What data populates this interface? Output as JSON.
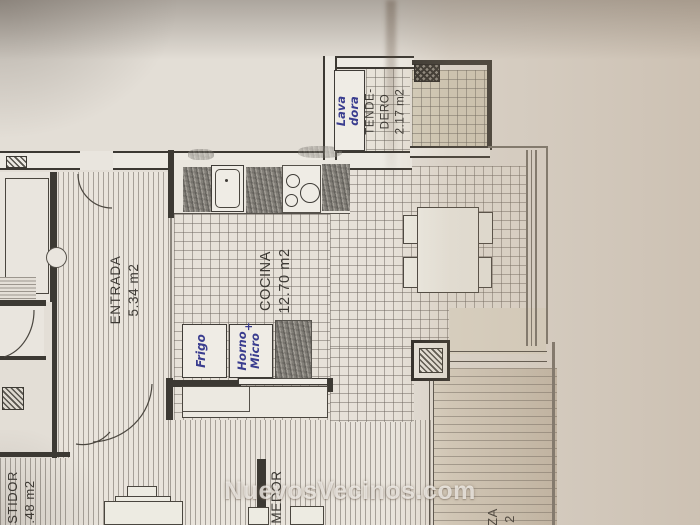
{
  "watermark": "NuevosVecinos.com",
  "colors": {
    "ink_blue": "#3a3d8f",
    "plan_line": "#3c3933",
    "paper": "#e3ded6"
  },
  "rooms": {
    "entrada": {
      "name": "ENTRADA",
      "area": "5.34 m2"
    },
    "cocina": {
      "name": "COCINA",
      "area": "12.70 m2"
    },
    "tendedero": {
      "name_line1": "TENDE-",
      "name_line2": "DERO",
      "area": "2.17 m2"
    },
    "vestidor": {
      "name_partial": "ESTIDOR",
      "area_partial": ".48 m2"
    },
    "comedor": {
      "name_partial": "MEDOR"
    },
    "terraza": {
      "name_partial": "ZA",
      "area_partial": "2"
    }
  },
  "handwritten": {
    "washer": {
      "line1": "Lava",
      "line2": "dora"
    },
    "fridge": "Frigo",
    "oven": {
      "line1": "Horno",
      "plus": "+",
      "line2": "Micro"
    }
  }
}
